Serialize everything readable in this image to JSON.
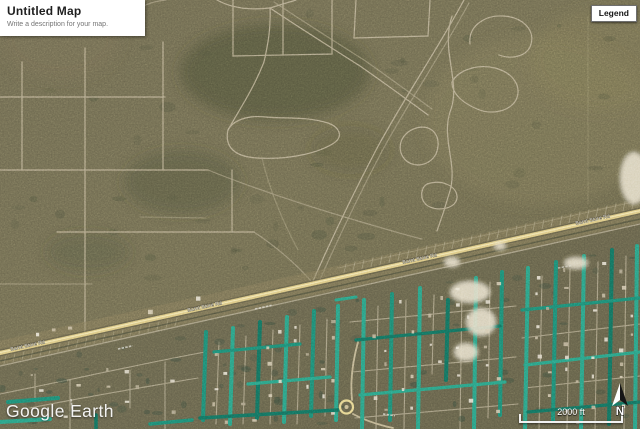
{
  "header": {
    "title": "Untitled Map",
    "description_placeholder": "Write a description for your map."
  },
  "legend": {
    "label": "Legend"
  },
  "map_overlay": {
    "watermark": "Google Earth",
    "scale_label": "2000 ft",
    "north_label": "N"
  },
  "map": {
    "view": "satellite",
    "highway_label": "Burnt Store Rd",
    "colors": {
      "terrain_upper": "#6f6a50",
      "terrain_dark_patch": "#454a33",
      "terrain_lower_tint": "#5d5a46",
      "platted_road": "#c6b99c",
      "highway": "#e0cb82",
      "canal_teal": "#1e8a73",
      "canal_bright": "#2ba184",
      "sand": "#e9e1ca"
    }
  }
}
